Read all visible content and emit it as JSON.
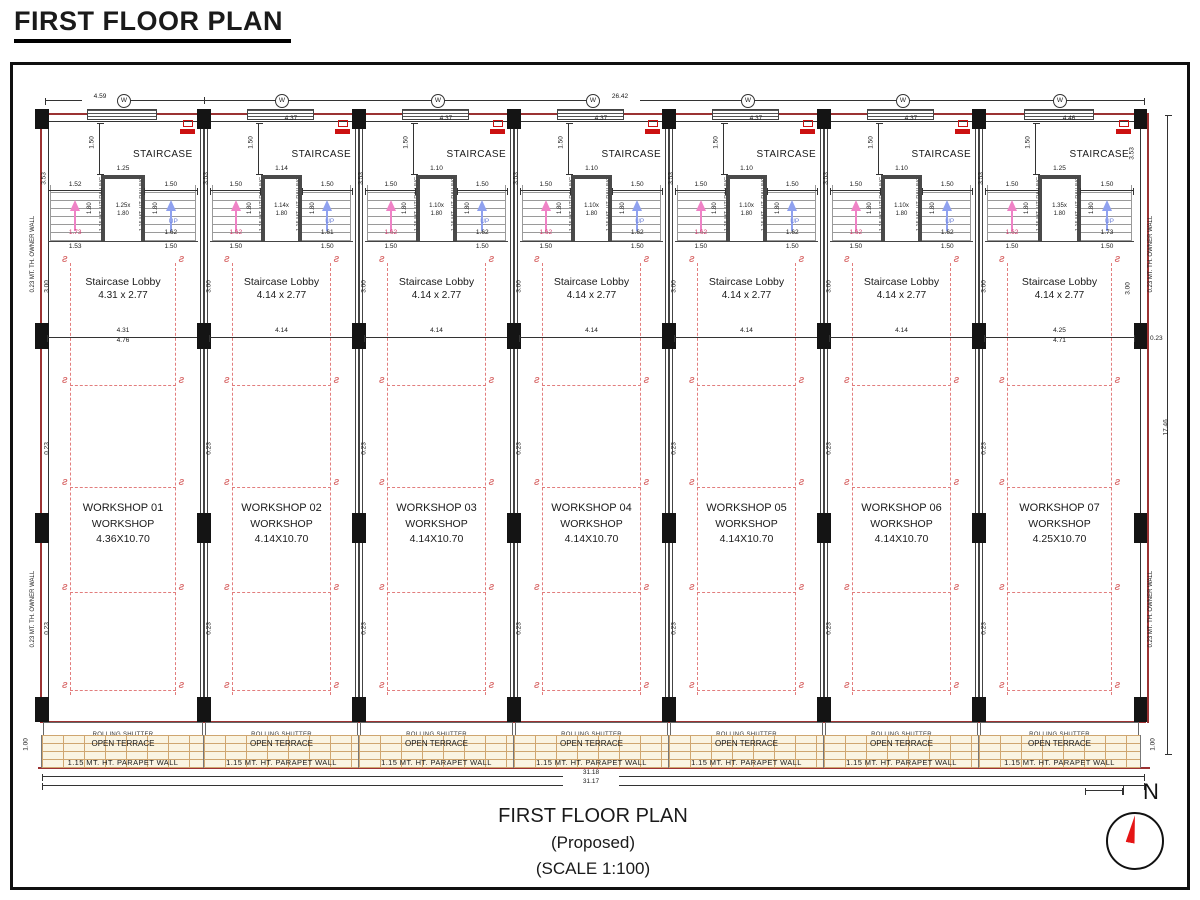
{
  "page_title": "FIRST FLOOR PLAN",
  "caption": {
    "line1": "FIRST FLOOR PLAN",
    "line2": "(Proposed)",
    "line3": "(SCALE 1:100)"
  },
  "labels": {
    "staircase": "STAIRCASE",
    "staircase_lobby": "Staircase Lobby",
    "workshop_sub": "WORKSHOP",
    "rolling_shutter": "ROLLING SHUTTER",
    "open_terrace": "OPEN TERRACE",
    "parapet": "1.15  MT.  HT.  PARAPET  WALL",
    "owner_wall": "0.23 MT. TH. OWNER WALL",
    "railing": "1.15 MT. HT. RAILING",
    "up": "UP",
    "window_mark": "W",
    "north": "N"
  },
  "dims": {
    "top_first": "4.59",
    "top_total": "26.42",
    "bottom_a": "31.18",
    "bottom_b": "31.17",
    "right_total": "17.46",
    "wall_thk": "0.23",
    "side_top": "3.53",
    "lobby_height": "3.00",
    "terrace_depth": "1.00",
    "stair_top": "1.50",
    "flight_len": "1.80"
  },
  "colors": {
    "wall_red": "#9b3232",
    "dash_red": "#e27d7d",
    "vent_red": "#cc1111",
    "up_blue": "#8fa1ef",
    "flight_pink": "#ef82c6",
    "brick_tan": "#cfa670",
    "north_red": "#e51515"
  },
  "units": [
    {
      "top_dim": "",
      "stair": {
        "left_w": "1.52",
        "right_w": "1.50",
        "well_top": "1.25",
        "well_a": "1.25x",
        "well_b": "1.80",
        "left_run": "1.73",
        "right_run": "1.62",
        "left_b": "1.53",
        "right_b": "1.50"
      },
      "lobby": {
        "size": "4.31  x  2.77",
        "dim_a": "4.31",
        "dim_b": "4.76"
      },
      "ws": {
        "name": "WORKSHOP 01",
        "size": "4.36X10.70"
      }
    },
    {
      "top_dim": "4.37",
      "stair": {
        "left_w": "1.50",
        "right_w": "1.50",
        "well_top": "1.14",
        "well_a": "1.14x",
        "well_b": "1.80",
        "left_run": "1.62",
        "right_run": "1.61",
        "left_b": "1.50",
        "right_b": "1.50"
      },
      "lobby": {
        "size": "4.14  x  2.77",
        "dim_a": "4.14",
        "dim_b": ""
      },
      "ws": {
        "name": "WORKSHOP 02",
        "size": "4.14X10.70"
      }
    },
    {
      "top_dim": "4.37",
      "stair": {
        "left_w": "1.50",
        "right_w": "1.50",
        "well_top": "1.10",
        "well_a": "1.10x",
        "well_b": "1.80",
        "left_run": "1.62",
        "right_run": "1.62",
        "left_b": "1.50",
        "right_b": "1.50"
      },
      "lobby": {
        "size": "4.14  x  2.77",
        "dim_a": "4.14",
        "dim_b": ""
      },
      "ws": {
        "name": "WORKSHOP 03",
        "size": "4.14X10.70"
      }
    },
    {
      "top_dim": "4.37",
      "stair": {
        "left_w": "1.50",
        "right_w": "1.50",
        "well_top": "1.10",
        "well_a": "1.10x",
        "well_b": "1.80",
        "left_run": "1.62",
        "right_run": "1.62",
        "left_b": "1.50",
        "right_b": "1.50"
      },
      "lobby": {
        "size": "4.14  x  2.77",
        "dim_a": "4.14",
        "dim_b": ""
      },
      "ws": {
        "name": "WORKSHOP 04",
        "size": "4.14X10.70"
      }
    },
    {
      "top_dim": "4.37",
      "stair": {
        "left_w": "1.50",
        "right_w": "1.50",
        "well_top": "1.10",
        "well_a": "1.10x",
        "well_b": "1.80",
        "left_run": "1.62",
        "right_run": "1.62",
        "left_b": "1.50",
        "right_b": "1.50"
      },
      "lobby": {
        "size": "4.14  x  2.77",
        "dim_a": "4.14",
        "dim_b": ""
      },
      "ws": {
        "name": "WORKSHOP 05",
        "size": "4.14X10.70"
      }
    },
    {
      "top_dim": "4.37",
      "stair": {
        "left_w": "1.50",
        "right_w": "1.50",
        "well_top": "1.10",
        "well_a": "1.10x",
        "well_b": "1.80",
        "left_run": "1.62",
        "right_run": "1.62",
        "left_b": "1.50",
        "right_b": "1.50"
      },
      "lobby": {
        "size": "4.14  x  2.77",
        "dim_a": "4.14",
        "dim_b": ""
      },
      "ws": {
        "name": "WORKSHOP 06",
        "size": "4.14X10.70"
      }
    },
    {
      "top_dim": "4.46",
      "stair": {
        "left_w": "1.50",
        "right_w": "1.50",
        "well_top": "1.25",
        "well_a": "1.35x",
        "well_b": "1.80",
        "left_run": "1.62",
        "right_run": "1.73",
        "left_b": "1.50",
        "right_b": "1.50"
      },
      "lobby": {
        "size": "4.14  x  2.77",
        "dim_a": "4.25",
        "dim_b": "4.71"
      },
      "ws": {
        "name": "WORKSHOP 07",
        "size": "4.25X10.70"
      }
    }
  ]
}
